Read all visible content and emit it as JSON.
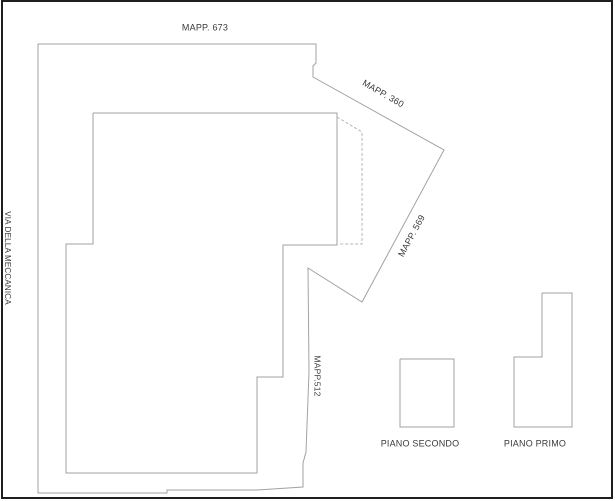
{
  "labels": {
    "mapp_673": "MAPP. 673",
    "mapp_360": "MAPP. 360",
    "mapp_569": "MAPP. 569",
    "mapp_512": "MAPP.512",
    "street": "VIA DELLA MECCANICA",
    "piano_secondo": "PIANO SECONDO",
    "piano_primo": "PIANO PRIMO"
  },
  "colors": {
    "bg": "#ffffff",
    "line": "#a2a2a2",
    "dashed": "#b5b5b5",
    "text": "#3a3a3a",
    "frame": "#1e1e1e"
  },
  "frame": {
    "x": 2,
    "y": 1,
    "width": 610,
    "height": 497
  },
  "shapes": {
    "parcel_boundary": "38,44 316,44 316,63 313,66 313,77 444,150 362,302 308,268 309,372 306,452 303,463 303,487 257,490 167,490 167,493 38,493 38,44",
    "building_ground": "93,113 337,113 337,245 283,245 283,377 257,377 257,473 66,473 66,244 93,244 93,113",
    "dashed_extension": "337,117 362,132 362,244 338,244",
    "piano_secondo": "400,359 454,359 454,427 400,427 400,359",
    "piano_primo": "542,293 572,293 572,427 514,427 514,357 542,357 542,293"
  }
}
